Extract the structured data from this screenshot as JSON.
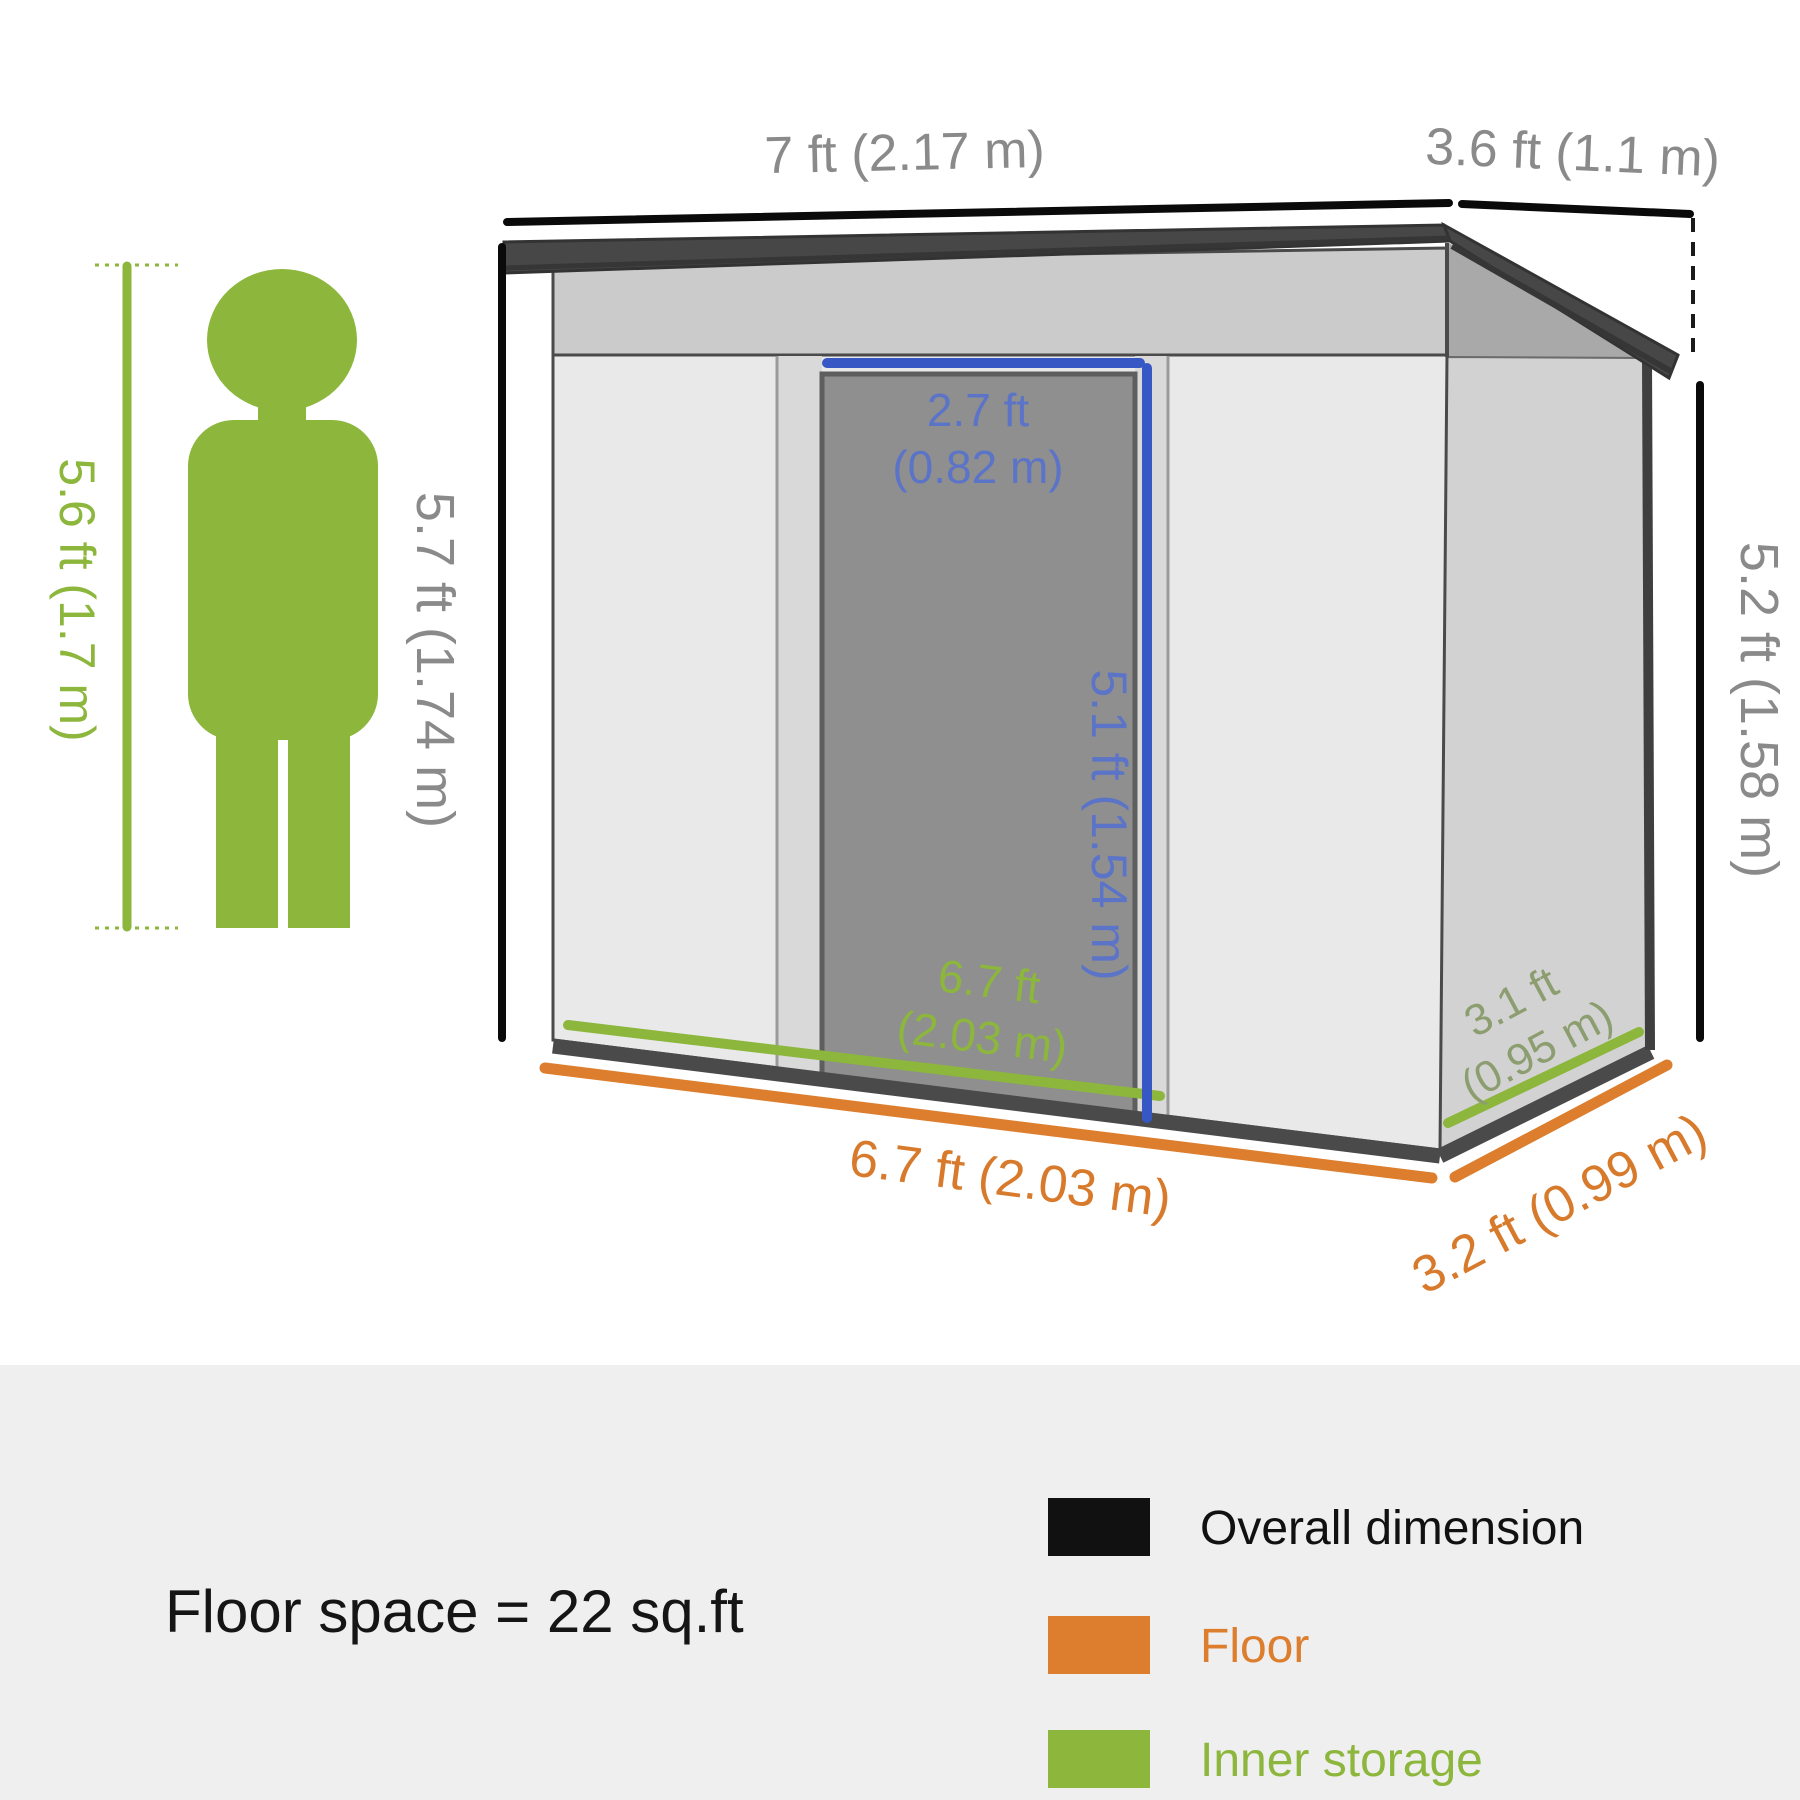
{
  "person": {
    "height_label": "5.6 ft (1.7 m)"
  },
  "shed": {
    "overall_width": "7 ft (2.17 m)",
    "overall_depth": "3.6 ft (1.1 m)",
    "front_height": "5.7 ft (1.74 m)",
    "back_height": "5.2 ft (1.58 m)",
    "door_width_line1": "2.7 ft",
    "door_width_line2": "(0.82 m)",
    "door_height": "5.1 ft (1.54 m)",
    "inner_width_line1": "6.7 ft",
    "inner_width_line2": "(2.03 m)",
    "inner_depth_line1": "3.1 ft",
    "inner_depth_line2": "(0.95 m)",
    "floor_width": "6.7 ft (2.03 m)",
    "floor_depth": "3.2 ft (0.99 m)"
  },
  "footer": {
    "floor_space": "Floor space = 22 sq.ft",
    "legend": [
      {
        "label": "Overall dimension",
        "color": "#111111"
      },
      {
        "label": "Floor",
        "color": "#dc7e2e"
      },
      {
        "label": "Inner storage",
        "color": "#8cb63c"
      }
    ]
  },
  "colors": {
    "accent_green": "#8cb63c",
    "accent_orange": "#dc7e2e",
    "accent_blue": "#3757c4",
    "dim_text_gray": "#8a8a8a",
    "roof_dark": "#474747",
    "footer_panel": "#efefef"
  }
}
